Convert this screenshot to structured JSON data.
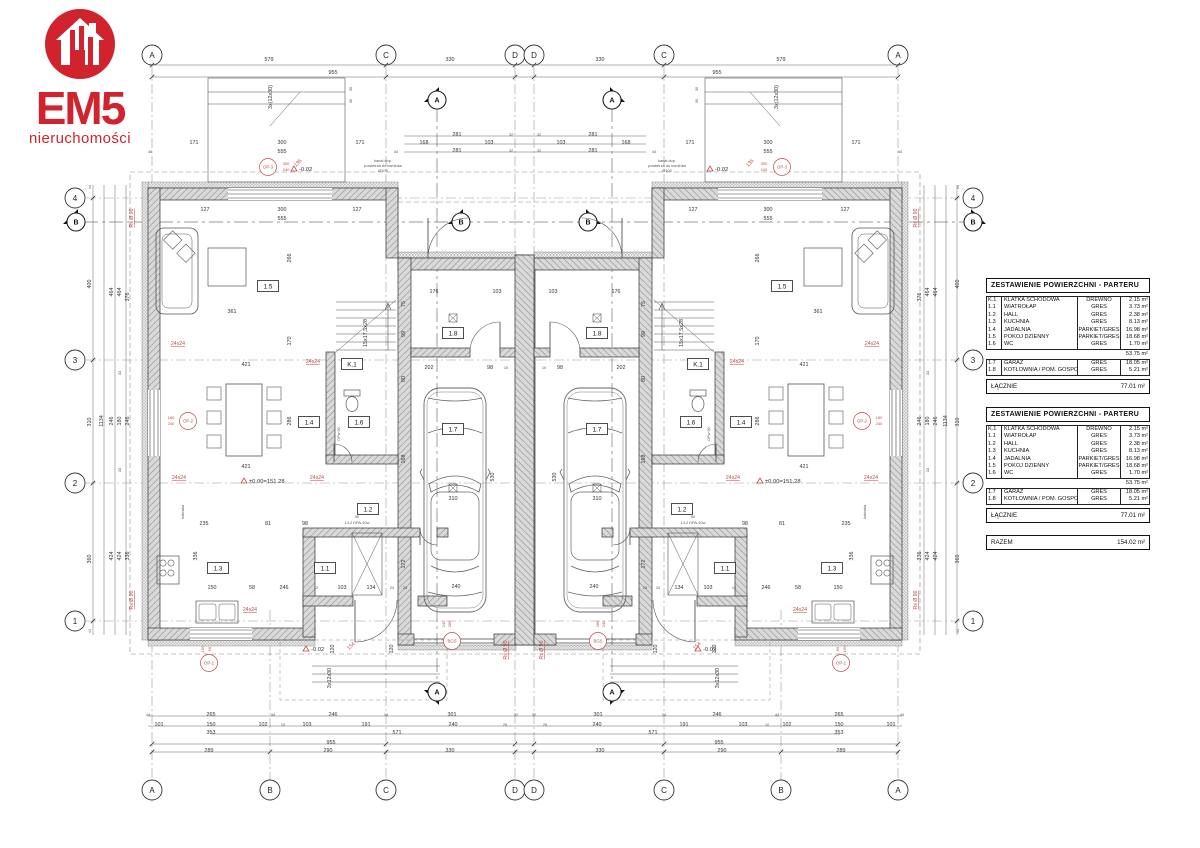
{
  "logo": {
    "title": "EM5",
    "subtitle": "nieruchomości",
    "icon": "house-icon"
  },
  "colors": {
    "logo_red": "#d0232e",
    "annotation_red": "#bf4a47",
    "line": "#444444",
    "wall_fill": "#d9d9d9"
  },
  "area_table": {
    "title": "ZESTAWIENIE POWIERZCHNI - PARTERU",
    "rows": [
      [
        "K.1",
        "KLATKA SCHODOWA",
        "DREWNO",
        "2.15 m²"
      ],
      [
        "1.1",
        "WIATROŁAP",
        "GRES",
        "3.73 m²"
      ],
      [
        "1.2",
        "HALL",
        "GRES",
        "2.38 m²"
      ],
      [
        "1.3",
        "KUCHNIA",
        "GRES",
        "8.13 m²"
      ],
      [
        "1.4",
        "JADALNIA",
        "PARKIET/GRES",
        "16.98 m²"
      ],
      [
        "1.5",
        "POKÓJ DZIENNY",
        "PARKIET/GRES",
        "18.68 m²"
      ],
      [
        "1.6",
        "WC",
        "GRES",
        "1.70 m²"
      ]
    ],
    "subtotal": "53.75 m²",
    "rows2": [
      [
        "1.7",
        "GARAŻ",
        "GRES",
        "18.05 m²"
      ],
      [
        "1.8",
        "KOTŁOWNIA / POM. GOSPOD.",
        "GRES",
        "5.21 m²"
      ]
    ],
    "total_label": "ŁĄCZNIE",
    "total_value": "77.01 m²"
  },
  "razem": {
    "label": "RAZEM",
    "value": "154.02 m²"
  },
  "grid": {
    "top": [
      [
        "A",
        152
      ],
      [
        "C",
        386
      ],
      [
        "D",
        515
      ],
      [
        "D",
        534
      ],
      [
        "C",
        664
      ],
      [
        "A",
        898
      ]
    ],
    "bottom": [
      [
        "A",
        152
      ],
      [
        "B",
        270
      ],
      [
        "C",
        386
      ],
      [
        "D",
        515
      ],
      [
        "D",
        534
      ],
      [
        "C",
        664
      ],
      [
        "B",
        781
      ],
      [
        "A",
        898
      ]
    ],
    "left": [
      [
        "4",
        198
      ],
      [
        "3",
        360
      ],
      [
        "2",
        483
      ],
      [
        "1",
        621
      ]
    ],
    "right": [
      [
        "4",
        198
      ],
      [
        "3",
        360
      ],
      [
        "2",
        483
      ],
      [
        "1",
        621
      ]
    ]
  },
  "sections": [
    [
      "A",
      437,
      100,
      "d"
    ],
    [
      "A",
      612,
      100,
      "l2"
    ],
    [
      "A",
      437,
      692,
      "u"
    ],
    [
      "A",
      612,
      692,
      "u2"
    ],
    [
      "B",
      76,
      222,
      "r"
    ],
    [
      "B",
      461,
      222,
      "r"
    ],
    [
      "B",
      588,
      222,
      "l"
    ],
    [
      "B",
      973,
      222,
      "l"
    ]
  ],
  "rooms": [
    [
      "1.5",
      268,
      286
    ],
    [
      "1.4",
      309,
      422
    ],
    [
      "1.6",
      359,
      422
    ],
    [
      "K.1",
      352,
      364
    ],
    [
      "1.3",
      218,
      568
    ],
    [
      "1.1",
      325,
      568
    ],
    [
      "1.2",
      368,
      509
    ],
    [
      "1.8",
      453,
      333
    ],
    [
      "1.7",
      453,
      429
    ]
  ],
  "red_circles": [
    [
      "OP-3",
      268,
      167
    ],
    [
      "OP-2",
      188,
      421
    ],
    [
      "OP-1",
      209,
      663
    ],
    [
      "BGS",
      452,
      641
    ]
  ],
  "levels": [
    [
      "±0.00=151.28",
      250,
      482
    ],
    [
      "-0.02",
      312,
      650
    ],
    [
      "-0.02",
      300,
      170
    ]
  ],
  "dims": [
    [
      "579",
      269,
      61,
      0,
      1,
      0
    ],
    [
      "330",
      450,
      61,
      0,
      1,
      0
    ],
    [
      "955",
      333,
      74,
      0,
      1,
      0
    ],
    [
      "281",
      457,
      136,
      0,
      1,
      0
    ],
    [
      "32",
      511,
      136,
      0,
      1,
      2
    ],
    [
      "168",
      424,
      144,
      0,
      1,
      0
    ],
    [
      "103",
      489,
      144,
      0,
      1,
      0
    ],
    [
      "281",
      457,
      152,
      0,
      1,
      0
    ],
    [
      "32",
      511,
      152,
      0,
      1,
      2
    ],
    [
      "171",
      194,
      144,
      0,
      1,
      0
    ],
    [
      "300",
      282,
      144,
      0,
      1,
      0
    ],
    [
      "171",
      360,
      144,
      0,
      1,
      0
    ],
    [
      "44",
      150,
      153,
      0,
      1,
      2
    ],
    [
      "555",
      282,
      153,
      0,
      1,
      0
    ],
    [
      "44",
      396,
      153,
      0,
      1,
      2
    ],
    [
      "127",
      205,
      211,
      0,
      1,
      0
    ],
    [
      "300",
      282,
      211,
      0,
      1,
      0
    ],
    [
      "127",
      357,
      211,
      0,
      1,
      0
    ],
    [
      "555",
      282,
      220,
      0,
      1,
      0
    ],
    [
      "361",
      232,
      313,
      0,
      1,
      0
    ],
    [
      "266",
      291,
      258,
      1,
      1,
      0
    ],
    [
      "286",
      291,
      421,
      1,
      1,
      0
    ],
    [
      "170",
      291,
      341,
      1,
      1,
      0
    ],
    [
      "421",
      246,
      366,
      0,
      1,
      0
    ],
    [
      "421",
      246,
      468,
      0,
      1,
      0
    ],
    [
      "235",
      204,
      525,
      0,
      1,
      0
    ],
    [
      "81",
      268,
      525,
      0,
      1,
      0
    ],
    [
      "98",
      305,
      525,
      0,
      1,
      0
    ],
    [
      "150",
      212,
      589,
      0,
      1,
      0
    ],
    [
      "58",
      252,
      589,
      0,
      1,
      0
    ],
    [
      "246",
      284,
      589,
      0,
      1,
      0
    ],
    [
      "12",
      316,
      589,
      0,
      1,
      2
    ],
    [
      "103",
      342,
      589,
      0,
      1,
      0
    ],
    [
      "134",
      371,
      589,
      0,
      1,
      0
    ],
    [
      "24",
      392,
      589,
      0,
      1,
      2
    ],
    [
      "28",
      405,
      589,
      0,
      1,
      2
    ],
    [
      "336",
      197,
      556,
      1,
      1,
      0
    ],
    [
      "176",
      434,
      293,
      0,
      1,
      0
    ],
    [
      "103",
      497,
      293,
      0,
      1,
      0
    ],
    [
      "202",
      429,
      369,
      0,
      1,
      0
    ],
    [
      "98",
      490,
      369,
      0,
      1,
      0
    ],
    [
      "10",
      506,
      369,
      0,
      1,
      2
    ],
    [
      "240",
      456,
      588,
      0,
      1,
      0
    ],
    [
      "310",
      453,
      500,
      0,
      1,
      0
    ],
    [
      "530",
      494,
      477,
      1,
      1,
      0
    ],
    [
      "168",
      405,
      459,
      1,
      1,
      0
    ],
    [
      "172",
      405,
      564,
      1,
      1,
      0
    ],
    [
      "80",
      405,
      379,
      1,
      1,
      0
    ],
    [
      "99",
      405,
      334,
      1,
      1,
      0
    ],
    [
      "75",
      405,
      304,
      1,
      1,
      0
    ],
    [
      "15x17,5x28",
      367,
      333,
      1,
      1,
      0
    ],
    [
      "90",
      357,
      518,
      0,
      1,
      2
    ],
    [
      "14,2 DPA-10w",
      357,
      524,
      0,
      1,
      2
    ],
    [
      "120",
      334,
      649,
      1,
      1,
      0
    ],
    [
      "120",
      393,
      649,
      1,
      1,
      0
    ],
    [
      "3x12x30",
      331,
      678,
      1,
      1,
      0
    ],
    [
      "44",
      148,
      716,
      0,
      1,
      2
    ],
    [
      "265",
      211,
      716,
      0,
      1,
      0
    ],
    [
      "44",
      273,
      716,
      0,
      1,
      2
    ],
    [
      "246",
      333,
      716,
      0,
      1,
      0
    ],
    [
      "24",
      386,
      716,
      0,
      1,
      2
    ],
    [
      "301",
      452,
      716,
      0,
      1,
      0
    ],
    [
      "32",
      516,
      716,
      0,
      1,
      2
    ],
    [
      "101",
      159,
      726,
      0,
      1,
      0
    ],
    [
      "150",
      211,
      726,
      0,
      1,
      0
    ],
    [
      "102",
      263,
      726,
      0,
      1,
      0
    ],
    [
      "10",
      283,
      726,
      0,
      1,
      2
    ],
    [
      "103",
      307,
      726,
      0,
      1,
      0
    ],
    [
      "191",
      366,
      726,
      0,
      1,
      0
    ],
    [
      "240",
      453,
      726,
      0,
      1,
      0
    ],
    [
      "28",
      505,
      726,
      0,
      1,
      2
    ],
    [
      "353",
      211,
      734,
      0,
      1,
      0
    ],
    [
      "571",
      397,
      734,
      0,
      1,
      0
    ],
    [
      "955",
      331,
      744,
      0,
      1,
      0
    ],
    [
      "289",
      209,
      752,
      0,
      1,
      0
    ],
    [
      "290",
      328,
      752,
      0,
      1,
      0
    ],
    [
      "330",
      450,
      752,
      0,
      1,
      0
    ],
    [
      "44",
      91,
      187,
      1,
      1,
      2
    ],
    [
      "400",
      91,
      284,
      1,
      1,
      0
    ],
    [
      "310",
      91,
      422,
      1,
      1,
      0
    ],
    [
      "360",
      91,
      559,
      1,
      1,
      0
    ],
    [
      "44",
      91,
      631,
      1,
      1,
      2
    ],
    [
      "1134",
      103,
      421,
      1,
      1,
      0
    ],
    [
      "464",
      113,
      292,
      1,
      1,
      0
    ],
    [
      "246",
      113,
      421,
      1,
      1,
      0
    ],
    [
      "424",
      113,
      556,
      1,
      1,
      0
    ],
    [
      "464",
      121,
      292,
      1,
      1,
      0
    ],
    [
      "180",
      121,
      421,
      1,
      1,
      0
    ],
    [
      "424",
      121,
      556,
      1,
      1,
      0
    ],
    [
      "376",
      129,
      297,
      1,
      1,
      0
    ],
    [
      "246",
      129,
      421,
      1,
      1,
      0
    ],
    [
      "336",
      129,
      556,
      1,
      1,
      0
    ],
    [
      "33",
      121,
      373,
      1,
      1,
      2
    ],
    [
      "33",
      121,
      470,
      1,
      1,
      2
    ],
    [
      "3x(12x30)",
      272,
      97,
      1,
      1,
      0
    ],
    [
      "30",
      352,
      89,
      1,
      1,
      2
    ],
    [
      "30",
      352,
      101,
      1,
      1,
      2
    ],
    [
      "lodówka",
      184,
      512,
      1,
      1,
      2
    ],
    [
      "kanał dop.",
      383,
      162,
      0,
      1,
      2
    ],
    [
      "powietrza do kominka",
      383,
      167,
      0,
      1,
      2
    ],
    [
      "Ø100",
      383,
      172,
      0,
      1,
      2
    ],
    [
      "Rs Ø 90",
      133,
      218,
      1,
      1,
      1
    ],
    [
      "Rs Ø 90",
      133,
      600,
      1,
      1,
      1
    ],
    [
      "Rs Ø 90",
      507,
      650,
      1,
      1,
      1
    ],
    [
      "135",
      299,
      164,
      2,
      1,
      1
    ],
    [
      "154",
      352,
      647,
      2,
      1,
      1
    ],
    [
      "24x24",
      178,
      345,
      0,
      1,
      1
    ],
    [
      "24x24",
      313,
      363,
      0,
      1,
      1
    ],
    [
      "24x24",
      179,
      479,
      0,
      1,
      1
    ],
    [
      "24x24",
      317,
      479,
      0,
      1,
      1
    ],
    [
      "24x24",
      250,
      611,
      0,
      1,
      1
    ],
    [
      "300",
      286,
      165,
      0,
      1,
      3
    ],
    [
      "240",
      286,
      171,
      0,
      1,
      3
    ],
    [
      "180",
      171,
      419,
      0,
      1,
      3
    ],
    [
      "240",
      171,
      425,
      0,
      1,
      3
    ],
    [
      "150",
      204,
      649,
      1,
      1,
      3
    ],
    [
      "60",
      211,
      649,
      1,
      1,
      3
    ],
    [
      "240",
      445,
      624,
      1,
      1,
      3
    ],
    [
      "285",
      451,
      624,
      1,
      1,
      3
    ],
    [
      "DPw 90",
      340,
      434,
      1,
      1,
      2
    ]
  ]
}
